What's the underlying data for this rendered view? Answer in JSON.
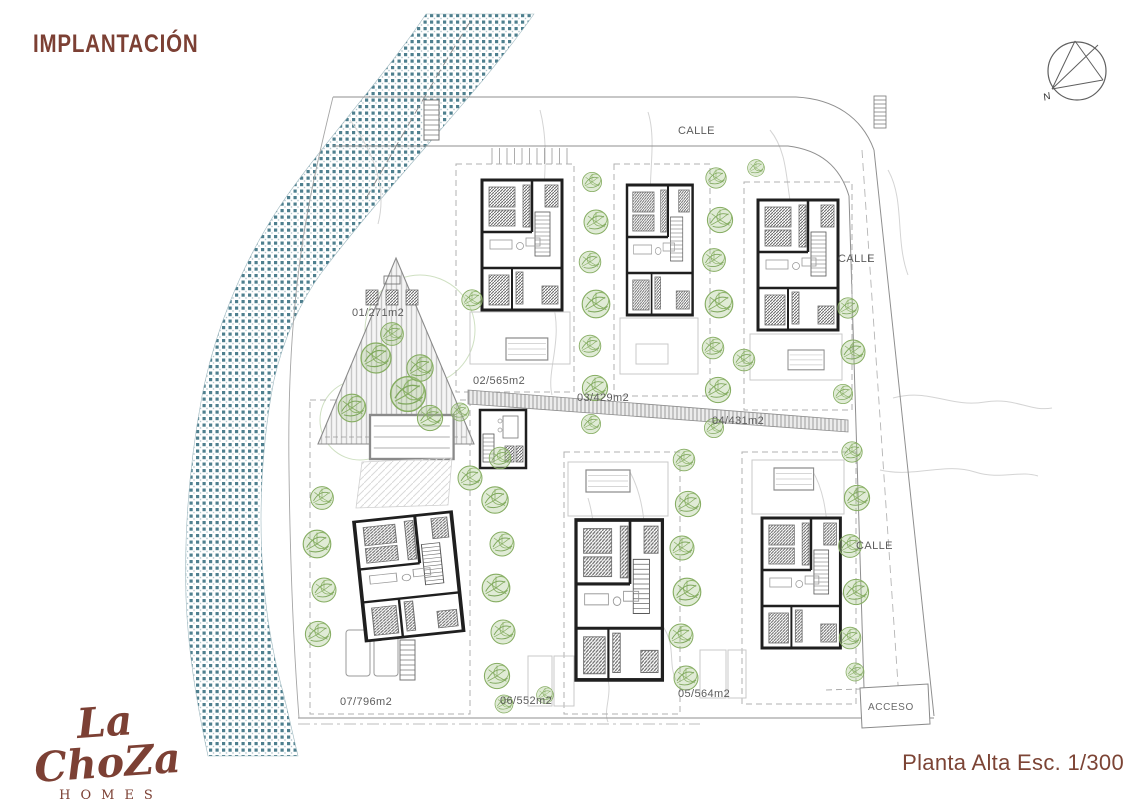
{
  "page": {
    "title": "IMPLANTACIÓN",
    "scale_label": "Planta Alta Esc. 1/300"
  },
  "logo": {
    "name": "La ChoZa",
    "subtitle": "HOMES"
  },
  "compass": {
    "north_label": "N"
  },
  "plan": {
    "street_labels": {
      "top": "CALLE",
      "right_upper": "CALLE",
      "right_lower": "CALLE"
    },
    "access_label": "ACCESO",
    "plots": [
      {
        "id": "01",
        "label": "01/271m2"
      },
      {
        "id": "02",
        "label": "02/565m2"
      },
      {
        "id": "03",
        "label": "03/429m2"
      },
      {
        "id": "04",
        "label": "04/431m2"
      },
      {
        "id": "05",
        "label": "05/564m2"
      },
      {
        "id": "06",
        "label": "06/552m2"
      },
      {
        "id": "07",
        "label": "07/796m2"
      }
    ],
    "colors": {
      "brand_brown": "#7c4034",
      "river_teal": "#4e7f8e",
      "vegetation_green": "#86ad62",
      "wall_black": "#1f1f1f",
      "line_gray": "#9a9a9a"
    }
  }
}
